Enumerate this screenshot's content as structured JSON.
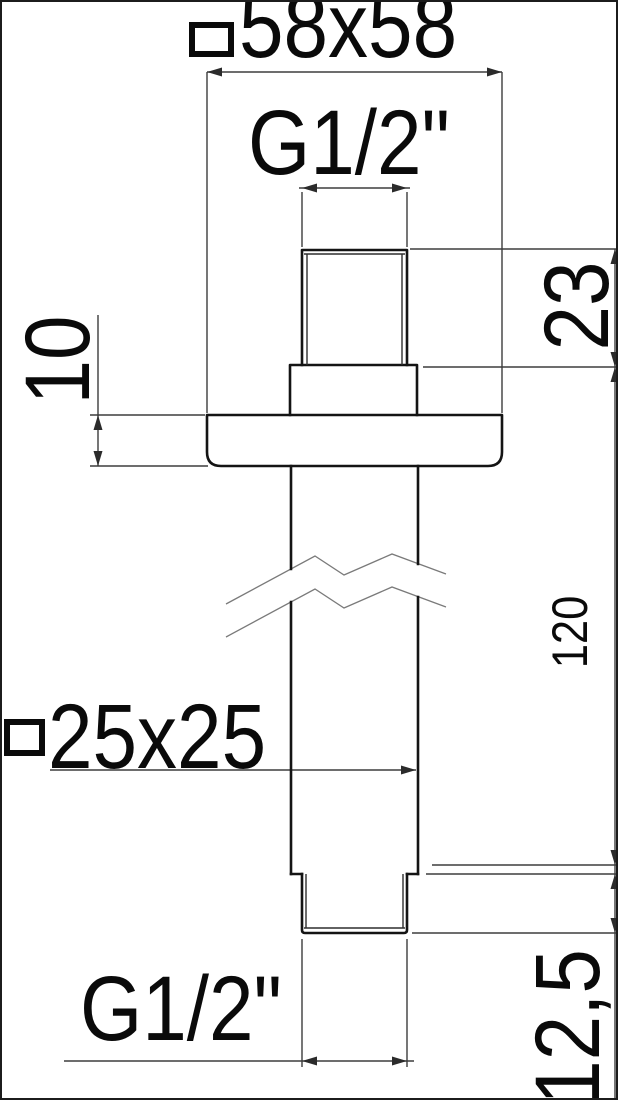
{
  "drawing": {
    "dimensions": {
      "head_section": {
        "symbol": "□",
        "value": "58x58"
      },
      "top_thread": {
        "value": "G1/2\""
      },
      "top_thread_length": {
        "value": "23"
      },
      "flange_thickness": {
        "value": "10"
      },
      "arm_length": {
        "value": "120"
      },
      "body_section": {
        "symbol": "□",
        "value": "25x25"
      },
      "bottom_thread": {
        "value": "G1/2\""
      },
      "bottom_thread_length": {
        "value": "12,5"
      }
    },
    "colors": {
      "background": "#ffffff",
      "object_line": "#141414",
      "dimension_line": "#3d3d3d",
      "text": "#0a0a0a",
      "break_line": "#7a7a7a",
      "frame_border": "#1c1c1c"
    }
  }
}
